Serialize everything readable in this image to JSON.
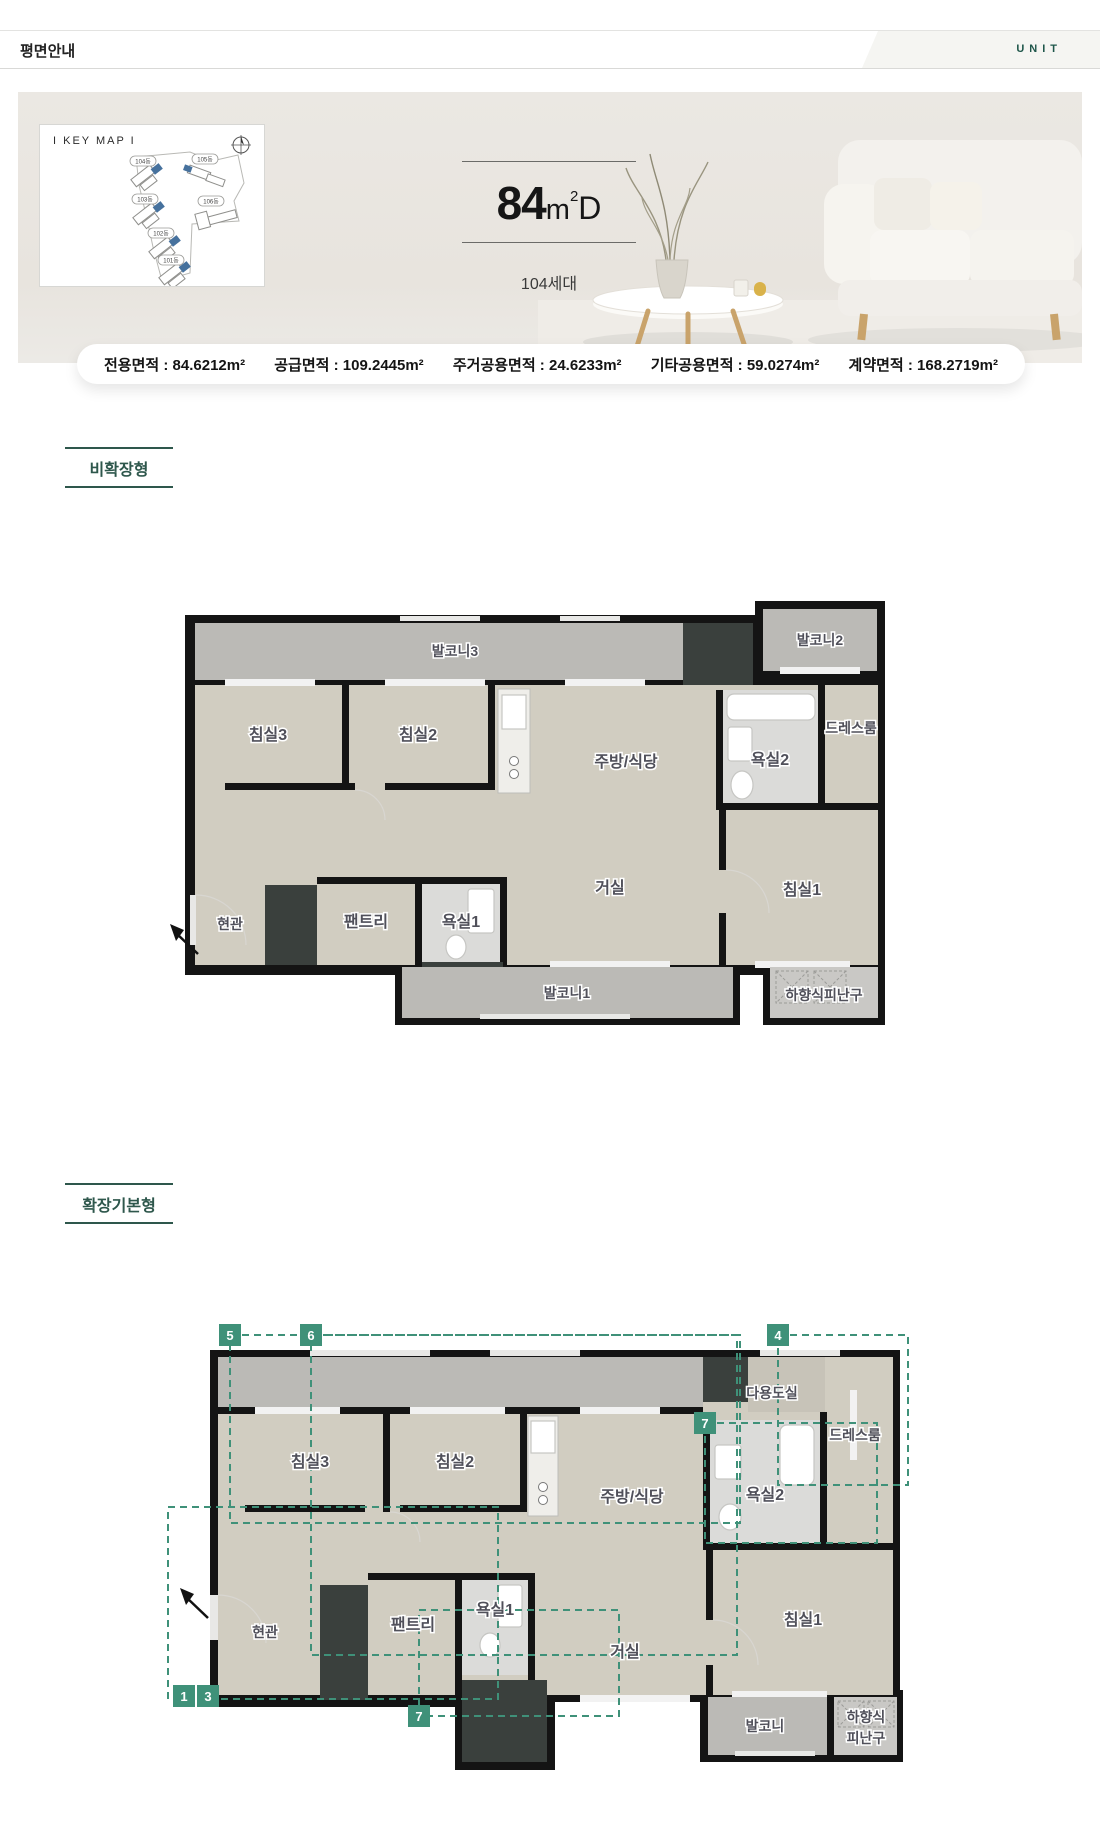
{
  "header": {
    "title": "평면안내",
    "unit": "UNIT"
  },
  "hero": {
    "keymap_label": "I KEY MAP I",
    "buildings": [
      "104동",
      "105동",
      "103동",
      "106동",
      "102동",
      "101동"
    ],
    "size_num": "84",
    "size_m": "m",
    "size_sup": "2",
    "size_type": "D",
    "households": "104세대"
  },
  "info": {
    "items": [
      "전용면적 : 84.6212m²",
      "공급면적 : 109.2445m²",
      "주거공용면적 : 24.6233m²",
      "기타공용면적 : 59.0274m²",
      "계약면적 : 168.2719m²"
    ]
  },
  "plan_a": {
    "section_label": "비확장형",
    "rooms": {
      "balcony3": "발코니3",
      "balcony2": "발코니2",
      "bedroom3": "침실3",
      "bedroom2": "침실2",
      "kitchen": "주방/식당",
      "bath2": "욕실2",
      "dressroom": "드레스룸",
      "entrance": "현관",
      "pantry": "팬트리",
      "bath1": "욕실1",
      "living": "거실",
      "bedroom1": "침실1",
      "balcony1": "발코니1",
      "escape": "하향식피난구"
    }
  },
  "plan_b": {
    "section_label": "확장기본형",
    "rooms": {
      "utility": "다용도실",
      "dressroom": "드레스룸",
      "bedroom3": "침실3",
      "bedroom2": "침실2",
      "kitchen": "주방/식당",
      "bath2": "욕실2",
      "entrance": "현관",
      "pantry": "팬트리",
      "bath1": "욕실1",
      "living": "거실",
      "bedroom1": "침실1",
      "balcony": "발코니",
      "escape_line1": "하향식",
      "escape_line2": "피난구"
    },
    "badges": {
      "b5": "5",
      "b6": "6",
      "b4": "4",
      "b7a": "7",
      "b1": "1",
      "b3": "3",
      "b7b": "7"
    }
  },
  "colors": {
    "accent_green": "#2e574c",
    "badge_green": "#3f9179",
    "keymap_blue": "#46719d"
  }
}
